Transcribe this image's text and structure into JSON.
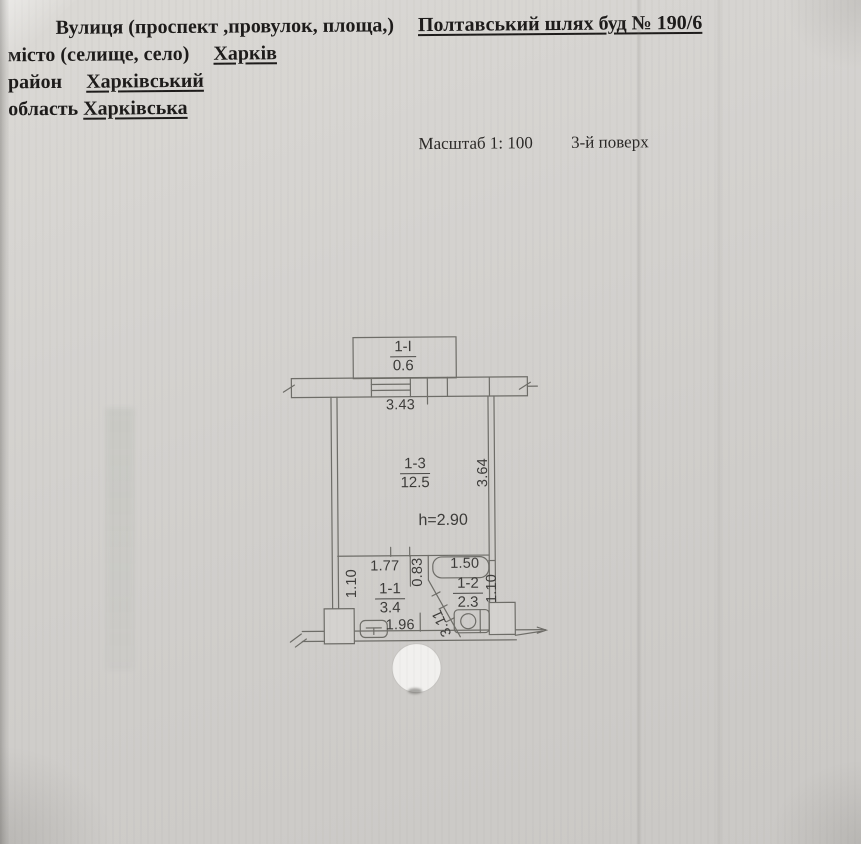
{
  "document": {
    "header": {
      "street_label": "Вулиця (проспект ,провулок, площа,)",
      "street_value": "Полтавський шлях буд № 190/6",
      "city_label": "місто (селище, село)",
      "city_value": "Харків",
      "district_label": "район",
      "district_value": "Харківський",
      "region_label": "область",
      "region_value": "Харківська",
      "scale_label": "Масштаб 1: 100",
      "floor_label": "3-й поверх"
    },
    "plan": {
      "balcony": {
        "number": "1-I",
        "area": "0.6"
      },
      "top_width_dim": "3.43",
      "main_room": {
        "number": "1-3",
        "area": "12.5",
        "ceiling_height": "h=2.90",
        "right_depth_dim": "3.64"
      },
      "room_1_1": {
        "number": "1-1",
        "area": "3.4",
        "top_width_dim": "1.77",
        "left_height_dim": "1.10",
        "bottom_width_dim": "1.96"
      },
      "passage": {
        "width_dim": "0.83",
        "diagonal_dim": "3.11"
      },
      "room_1_2": {
        "number": "1-2",
        "area": "2.3",
        "top_width_dim": "1.50",
        "right_height_dim": "1.10"
      }
    },
    "colors": {
      "paper": "#d3d1ce",
      "ink": "#1d1b1a",
      "plan_line": "#6e6d68",
      "plan_text": "#3c3b39",
      "stamp_cover": "#f1f0ee"
    }
  }
}
